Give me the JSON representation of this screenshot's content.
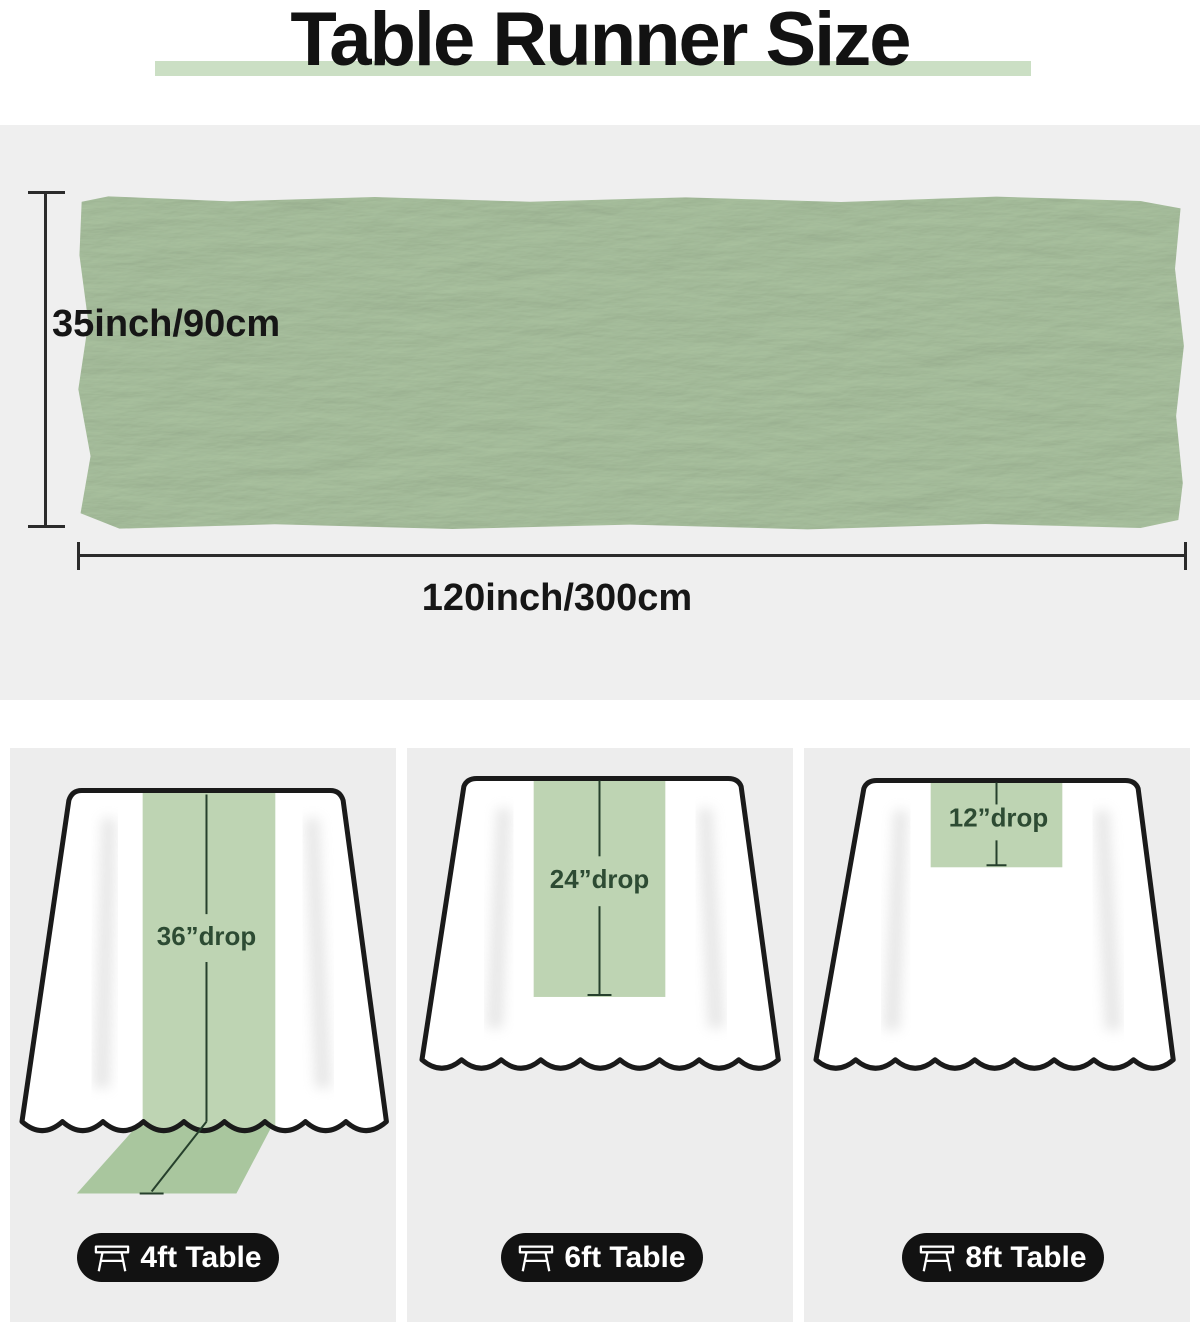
{
  "title": "Table Runner Size",
  "colors": {
    "highlight_bar": "#cbdfc4",
    "runner_fabric": "#b2cba7",
    "runner_strip": "#bed4b3",
    "runner_drape": "#a9c69e",
    "drop_label_text": "#2d4b33",
    "badge_background": "#121212",
    "section_background": "#efefef"
  },
  "runner_diagram": {
    "height_label": "35inch/90cm",
    "width_label": "120inch/300cm"
  },
  "panels": [
    {
      "drop_label": "36”drop",
      "table_label": "4ft Table",
      "icon": "table-icon"
    },
    {
      "drop_label": "24”drop",
      "table_label": "6ft Table",
      "icon": "table-icon"
    },
    {
      "drop_label": "12”drop",
      "table_label": "8ft Table",
      "icon": "table-icon"
    }
  ]
}
